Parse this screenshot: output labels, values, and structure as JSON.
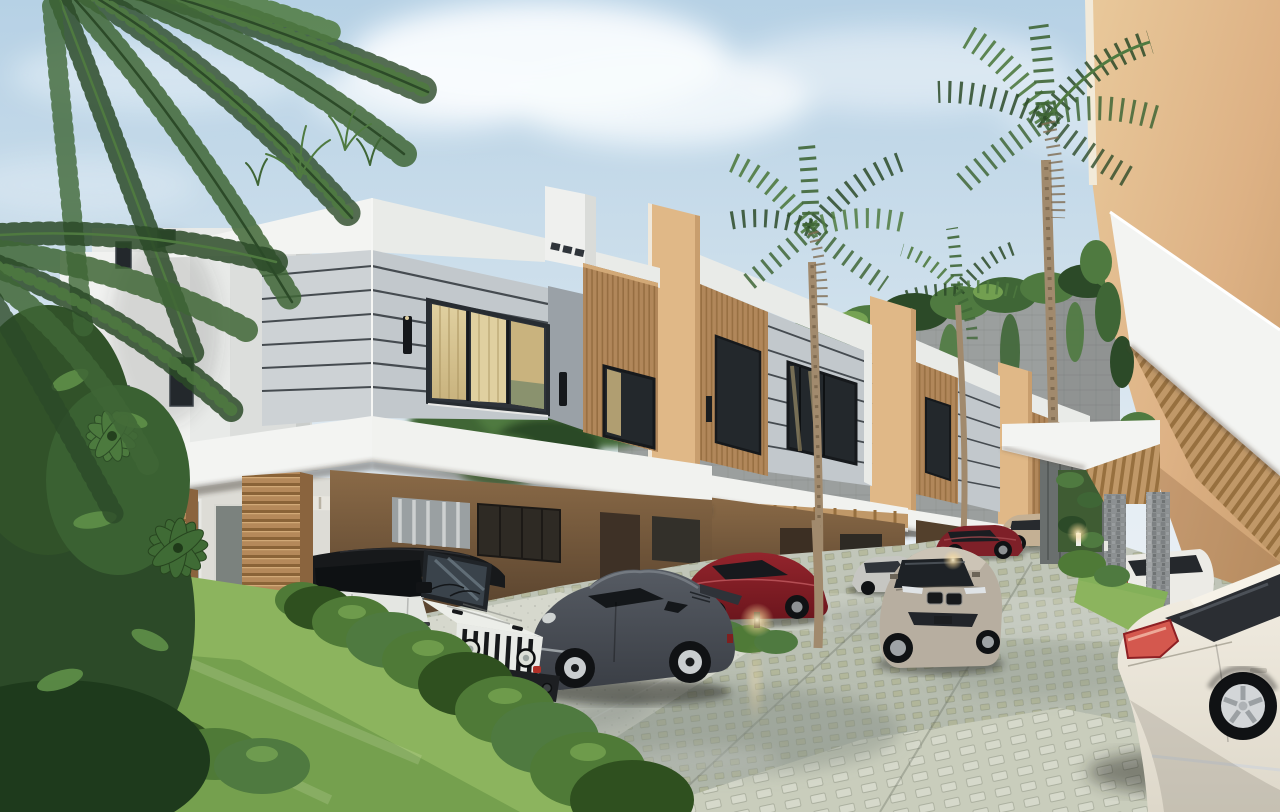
{
  "meta": {
    "kind": "3d-architectural-rendering",
    "setting": "tropical gated residential community at daytime",
    "view": "perspective down a paver driveway lined with modern two-storey townhouses"
  },
  "palette": {
    "sky1": "#b6d1e5",
    "sky2": "#cfe0ec",
    "sky3": "#e6eef4",
    "cloud": "#f9fcfe",
    "white1": "#f3f4f2",
    "white2": "#e9ebe8",
    "white3": "#dcdfdd",
    "fascia": "#f1f2ef",
    "panel1": "#cdd2d5",
    "panel2": "#c2c8cc",
    "panelLine": "#454b50",
    "panelDark": "#9aa1a7",
    "wood": "#b5895a",
    "woodDark": "#8a6337",
    "woodLight": "#d2a977",
    "woodPanel": "#b1875a",
    "fin": "#e0b887",
    "finShade": "#c89e6e",
    "tanWall": "#ddb184",
    "tanWallLit": "#e9c99b",
    "tanWallShade": "#c79c6c",
    "soffit": "#c09868",
    "soffitLine": "#97703f",
    "glass": "#23282c",
    "frame": "#16191c",
    "curtain1": "#e0d0a0",
    "curtain2": "#c9b37e",
    "curtain3": "#b09a66",
    "blockWall": "#9b9f9e",
    "stone": "#8b8f90",
    "leafDark": "#2c4a28",
    "leaf": "#3f6636",
    "leafMid": "#4f7a40",
    "leafLight": "#659455",
    "leafPale": "#7fae57",
    "grass1": "#8cb45e",
    "grass2": "#639042",
    "hedge": "#4f7a37",
    "hedgeDark": "#2f501f",
    "trunk": "#a18a6d",
    "trunkDark": "#7e6a50",
    "pave1": "#c3c8bb",
    "pave2": "#aeb5a8",
    "pave3": "#d6d8cd",
    "pave4": "#c9cdbc",
    "paveWet": "#848d84",
    "paveSage": "#adb089",
    "jeep": "#e4e6e2",
    "jeepHood": "#eceee9",
    "jeepDark": "#17191b",
    "tire": "#101214",
    "rim": "#3f4246",
    "porsche1": "#565b63",
    "porsche2": "#3a3e45",
    "red1a": "#93242c",
    "red1b": "#6c161d",
    "red2": "#7e2028",
    "silver": "#c6c6c2",
    "bmw1": "#ccc4b6",
    "bmw2": "#b7aea0",
    "cayenne": "#c4b094",
    "merc1": "#f2ede2",
    "merc2": "#ded8ca",
    "mercGlass": "#2b2e33",
    "tail": "#8e2024",
    "tailLight": "#d4584e",
    "chrome": "#d3d6d8",
    "glowC": "#ffdf9e",
    "lightWarm": "#ffd98f",
    "shadow": "#20241f"
  },
  "scene": {
    "sky": {
      "condition": "partly cloudy, soft white clouds upper right"
    },
    "background": {
      "retaining_wall": "tall grey concrete block wall with lush vines spilling over the top",
      "palms": [
        "tall fan palm center-left of wall",
        "tall fan palm right of center",
        "small palm mid-distance"
      ]
    },
    "townhouses": {
      "visible_units": 5,
      "features": [
        "white parapets",
        "light grey panels with thin dark horizontal reveals",
        "vertical wood slat accent panels",
        "tan projecting fin walls",
        "dark framed windows with warm curtains",
        "black up/down wall sconces",
        "white cantilevered carport canopies with wood slat soffits",
        "chunky wood slat carport pillars"
      ]
    },
    "right_building": "tan stucco volume with deep white canopy and wood slat soffit, stone-clad pillars, small lawn strip",
    "vehicles": [
      {
        "name": "jeep-wrangler",
        "color": "white, black soft top, seven-slot grille",
        "position": "foreground carport left"
      },
      {
        "name": "porsche-911",
        "color": "dark grey",
        "position": "beside jeep"
      },
      {
        "name": "sports-coupe",
        "color": "dark red",
        "position": "second carport"
      },
      {
        "name": "sedan",
        "color": "silver",
        "position": "mid distance"
      },
      {
        "name": "bmw-8-series-coupe",
        "color": "champagne",
        "position": "middle of driveway facing viewer"
      },
      {
        "name": "sedan",
        "color": "dark red",
        "position": "far carport"
      },
      {
        "name": "porsche-cayenne-suv",
        "color": "beige",
        "position": "end of driveway"
      },
      {
        "name": "sedan",
        "color": "white",
        "position": "distant right, behind stone pillars"
      },
      {
        "name": "mercedes-sedan",
        "color": "cream white",
        "position": "foreground bottom right, rear three-quarter view"
      }
    ],
    "vegetation": [
      "palm fronds overhanging top-left",
      "dense dark tropical shrubs lower-left",
      "bright lawn with trimmed hedge along driveway",
      "rooftop grass tufts"
    ],
    "driveway": {
      "surface": "permeable concrete pavers with sage-green grass joints",
      "detail": "wet reflective patches, light speckled carport aprons"
    },
    "lighting": [
      "warm bollard path lights along hedge",
      "recessed warm downlights under canopies"
    ]
  }
}
